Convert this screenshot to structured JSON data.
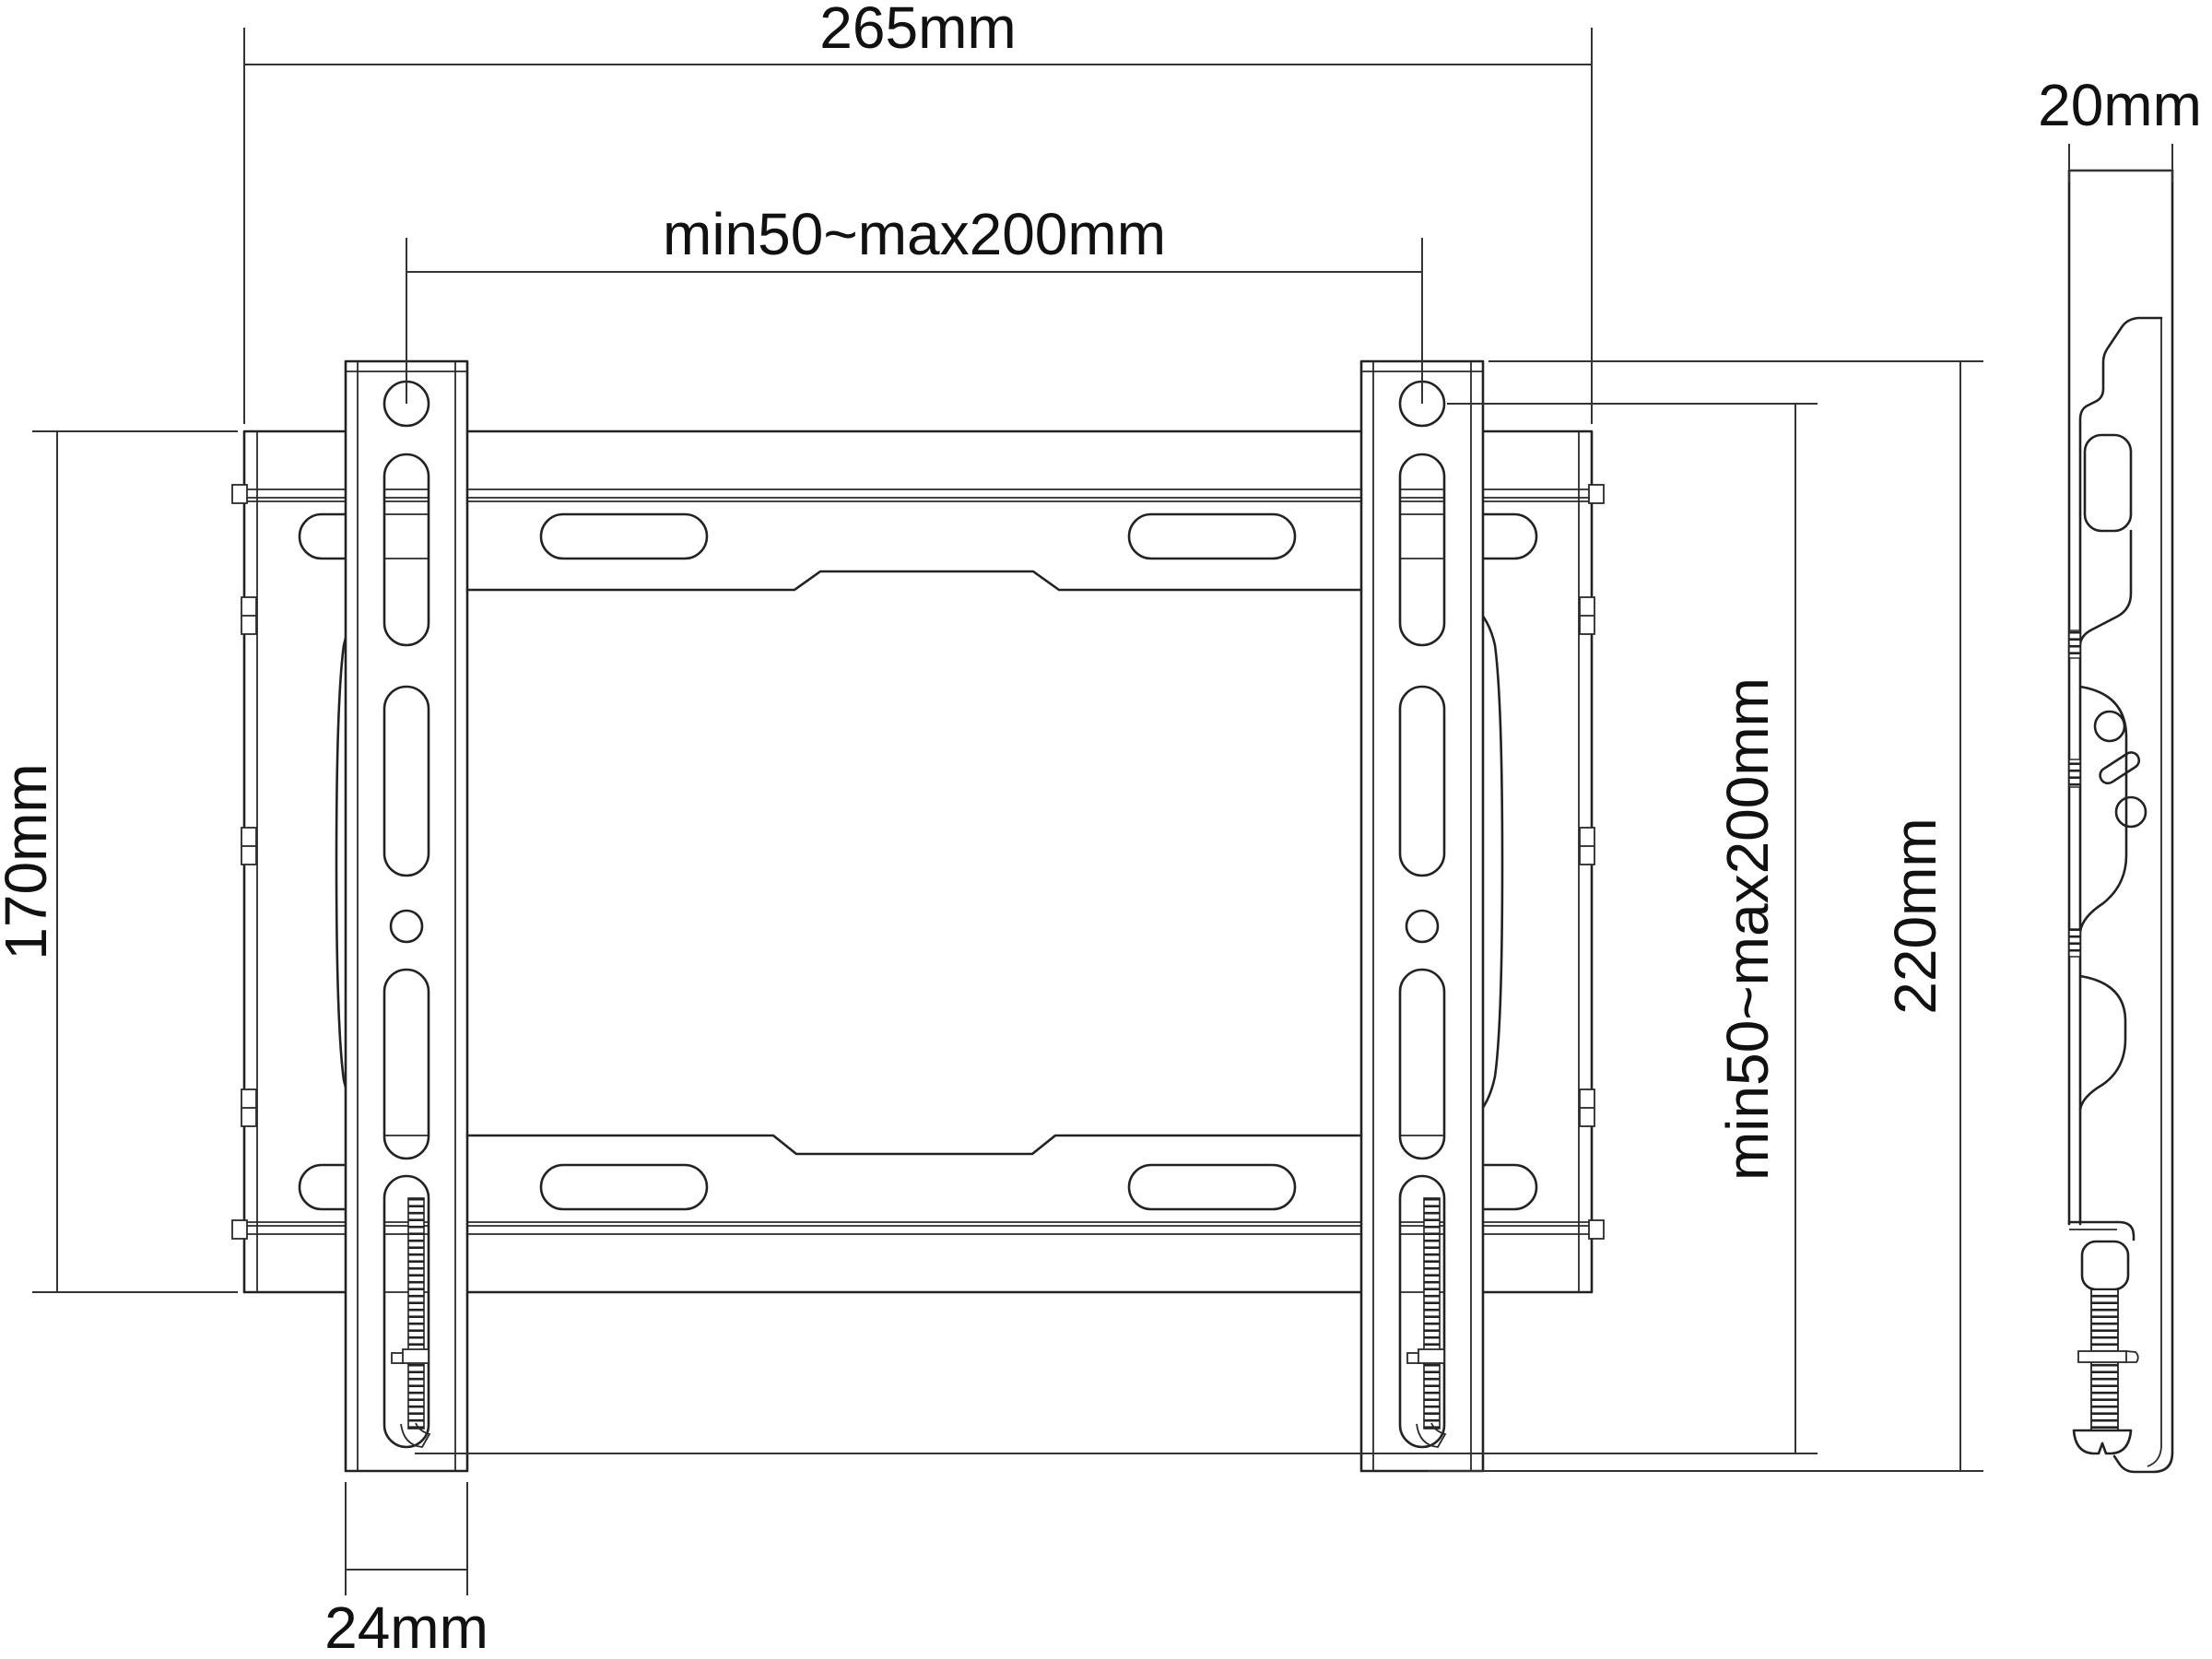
{
  "drawing": {
    "background": "#ffffff",
    "line_color": "#222222",
    "views": {
      "front_view": "front view of wall plate with two vertical TV rails",
      "side_view": "side profile with locking screw"
    },
    "dimensions": {
      "overall_width": "265mm",
      "horizontal_hole_spacing": "min50~max200mm",
      "plate_height": "170mm",
      "vertical_hole_spacing": "min50~max200mm",
      "rail_height": "220mm",
      "bracket_depth": "20mm",
      "rail_width": "24mm"
    }
  }
}
